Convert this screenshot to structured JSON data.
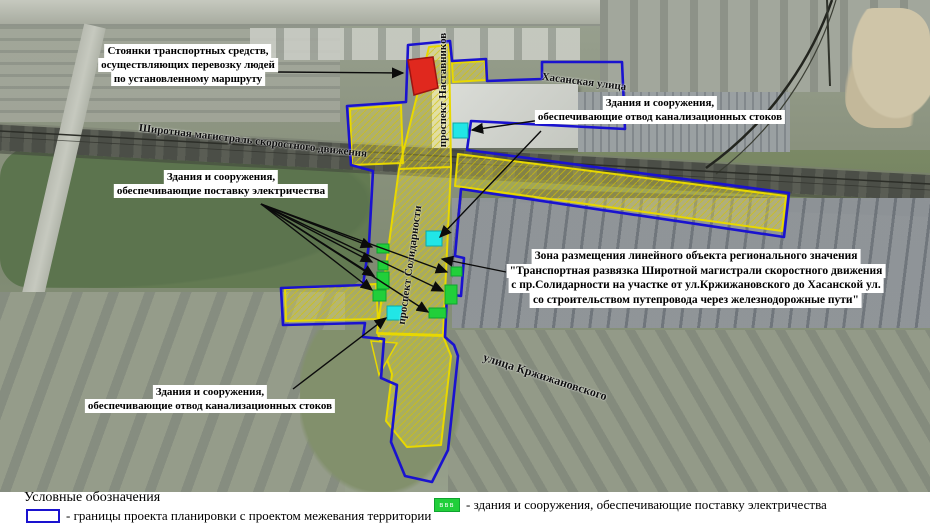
{
  "colors": {
    "boundary": "#1a12cf",
    "zone": "#e8d800",
    "parking": "#e0281e",
    "sewage": "#21e6e6",
    "green": "#21cf3a"
  },
  "streets": {
    "shirotnaya": "Широтная магистраль скоростного движения",
    "khasanskaya": "Хасанская улица",
    "nastavnikov": "проспект Наставников",
    "solidarnosti": "проспект Солидарности",
    "krzhizhanovskogo": "улица Кржижановского"
  },
  "callouts": {
    "parking": {
      "lines": [
        "Стоянки транспортных средств,",
        "осуществляющих перевозку людей",
        "по установленному маршруту"
      ]
    },
    "sewage_top": {
      "lines": [
        "Здания и сооружения,",
        "обеспечивающие отвод канализационных стоков"
      ]
    },
    "electricity": {
      "lines": [
        "Здания и сооружения,",
        "обеспечивающие поставку электричества"
      ]
    },
    "zone": {
      "lines": [
        "Зона размещения линейного объекта регионального значения",
        "\"Транспортная развязка Широтной магистрали скоростного движения",
        "с пр.Солидарности на участке от ул.Кржижановского до Хасанской ул.",
        "со строительством путепровода через железнодорожные пути\""
      ]
    },
    "sewage_bottom": {
      "lines": [
        "Здания и сооружения,",
        "обеспечивающие отвод канализационных стоков"
      ]
    }
  },
  "legend": {
    "title": "Условные обозначения",
    "items": [
      {
        "symbol": "boundary",
        "label": "- границы проекта планировки с проектом межевания территории"
      },
      {
        "symbol": "electricity",
        "swatch_text": "ввв",
        "label": "- здания и сооружения, обеспечивающие поставку электричества"
      }
    ]
  }
}
